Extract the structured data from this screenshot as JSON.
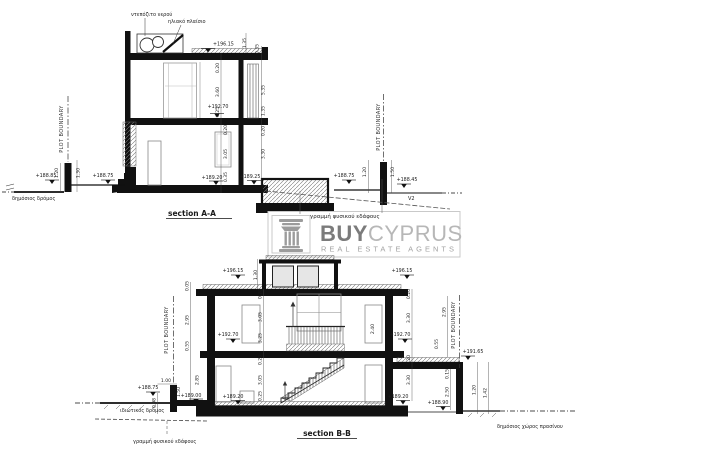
{
  "section_a": {
    "title": "section A-A",
    "water_tank_label": "ντεπόζιτο νερού",
    "solar_panel_label": "ηλιακό πλαίσιο",
    "plot_boundary_left": "PLOT BOUNDARY",
    "plot_boundary_right": "PLOT BOUNDARY",
    "public_road_label": "δημόσιος δρόμος",
    "v2_label": "V2",
    "levels": {
      "roof": "+196.15",
      "first_floor": "+192.70",
      "ground_left": "+189.20",
      "ground_right": "+189.25",
      "road": "+188.85",
      "pavement": "+188.75",
      "yard_right": "+188.75",
      "far_right": "+188.45"
    },
    "dims": {
      "panel": "1.35",
      "roof_edge": "0.35",
      "u_slab": "0.20",
      "u_room": "3.60",
      "u_sill": "0.25",
      "l_slab": "0.20",
      "l_room": "3.05",
      "l_plinth": "0.35",
      "louver_h": "5.35",
      "louver_b": "1.35",
      "r_slab": "0.20",
      "r_room": "3.30",
      "lw_a": "1.20",
      "lw_b": "1.30",
      "rw_a": "1.20",
      "rw_b": "1.50"
    }
  },
  "logo": {
    "buy": "BUY",
    "cyprus": "CYPRUS",
    "tagline": "REAL ESTATE AGENTS"
  },
  "mid_ground_label": "γραμμή φυσικού εδάφους",
  "section_b": {
    "title": "section B-B",
    "plot_boundary_left": "PLOT BOUNDARY",
    "plot_boundary_right": "PLOT BOUNDARY",
    "private_road_label": "ιδιωτικός δρόμος",
    "green_space_label": "δημόσιος χώρος πρασίνου",
    "ground_line_label": "γραμμή φυσικού εδάφους",
    "levels": {
      "roof_left": "+196.15",
      "roof_right": "+196.15",
      "first_left": "+192.70",
      "first_right": "+192.70",
      "ground_left": "+189.20",
      "ground_right": "+189.20",
      "road": "+188.75",
      "entrance": "+189.00",
      "terrace_right": "+191.65",
      "yard_right": "+188.90"
    },
    "dims": {
      "bulkhead": "1.30",
      "coping": "0.05",
      "ext_u": "2.95",
      "ext_m": "0.55",
      "ext_g": "2.85",
      "u_slab": "0.20",
      "u_room": "3.05",
      "u_total": "3.25",
      "g_slab": "0.20",
      "g_room": "3.05",
      "g_sill": "0.25",
      "door_u": "2.40",
      "r_u_slab": "0.20",
      "r_u_room": "3.30",
      "r_g_slab": "0.20",
      "r_g_room": "3.30",
      "r_par_a": "2.95",
      "r_par_b": "0.55",
      "terr_slab": "0.15",
      "terr_h": "2.50",
      "rw_a": "1.20",
      "rw_b": "1.42",
      "lw_a": "1.00",
      "lw_b": "1.50",
      "lw_c": "0.98"
    }
  }
}
